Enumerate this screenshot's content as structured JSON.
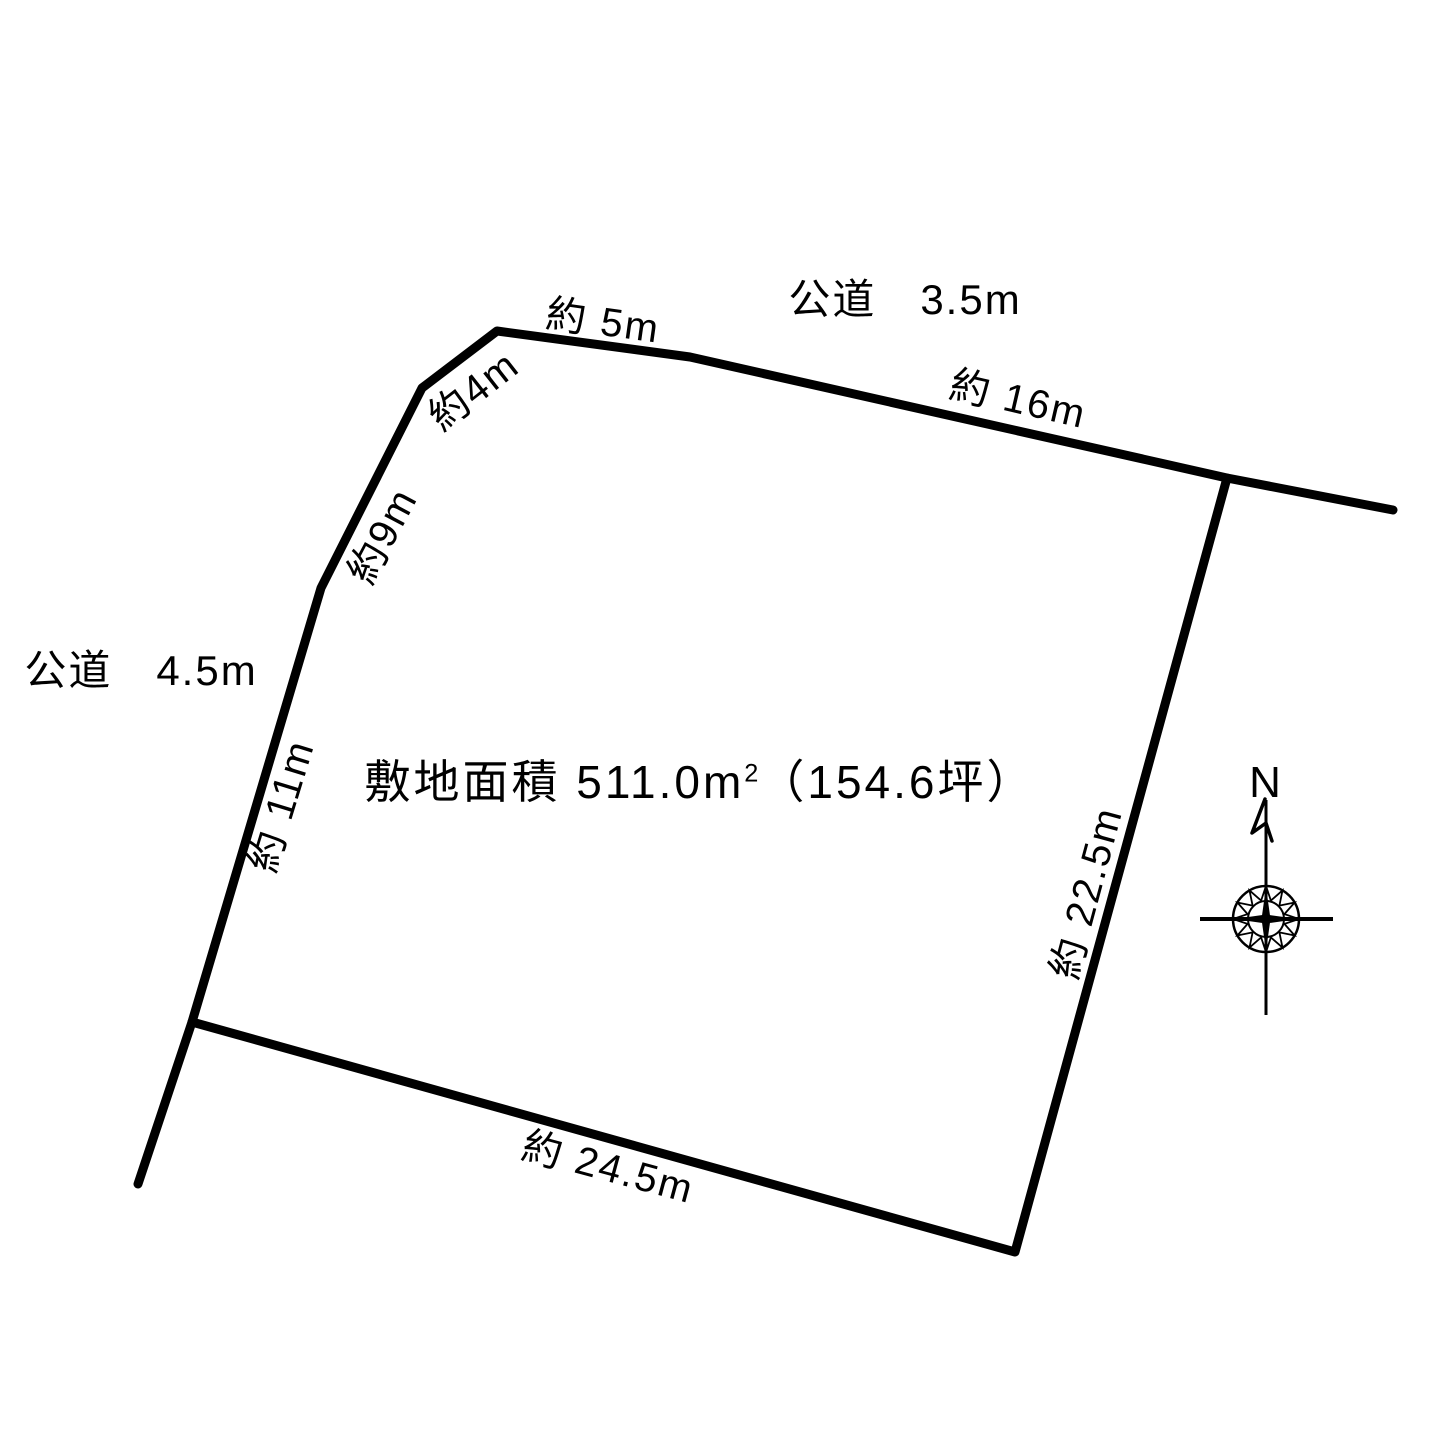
{
  "colors": {
    "background": "#ffffff",
    "line": "#000000",
    "text": "#000000"
  },
  "diagram": {
    "roads": {
      "top": "公道　3.5m",
      "left": "公道　4.5m"
    },
    "edges": {
      "top_first": "約 5m",
      "top_second": "約 16m",
      "northwest_upper": "約4m",
      "northwest_lower": "約9m",
      "west": "約 11m",
      "east": "約 22.5m",
      "south": "約 24.5m"
    },
    "area_label": {
      "prefix": "敷地面積 511.0m",
      "sup": "2",
      "suffix": "（154.6坪）"
    },
    "compass": {
      "north": "N"
    }
  }
}
